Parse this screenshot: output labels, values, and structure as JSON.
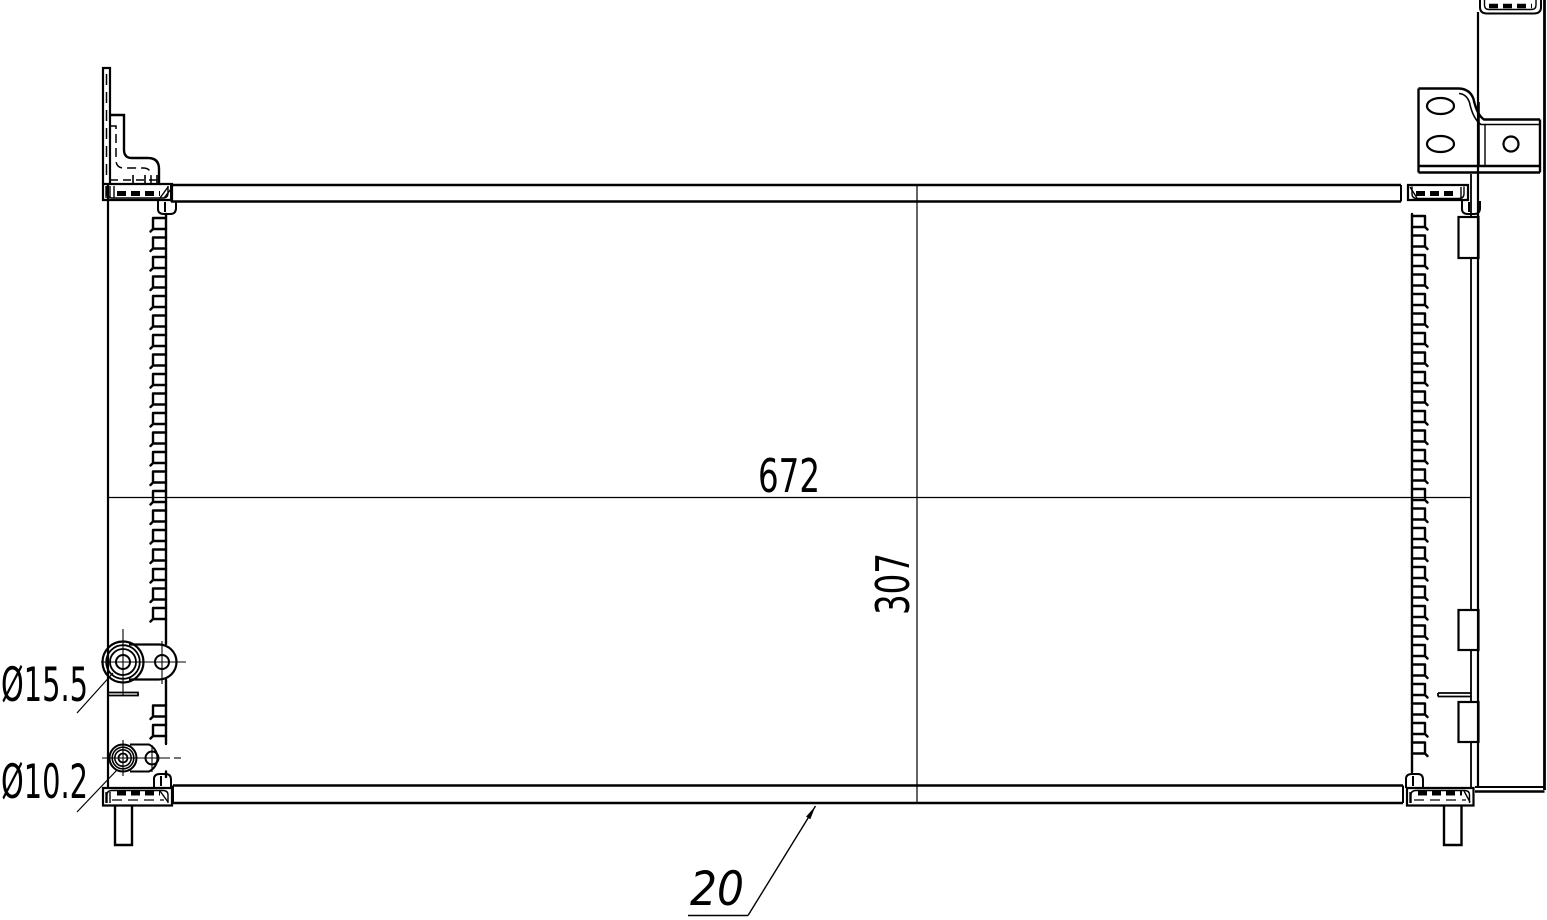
{
  "drawing_labels": {
    "core_width": "672",
    "core_height": "307",
    "inlet_diameter": "Ø15.5",
    "outlet_diameter": "Ø10.2",
    "thickness": "20"
  },
  "colors": {
    "line": "#000000",
    "background": "#ffffff"
  }
}
